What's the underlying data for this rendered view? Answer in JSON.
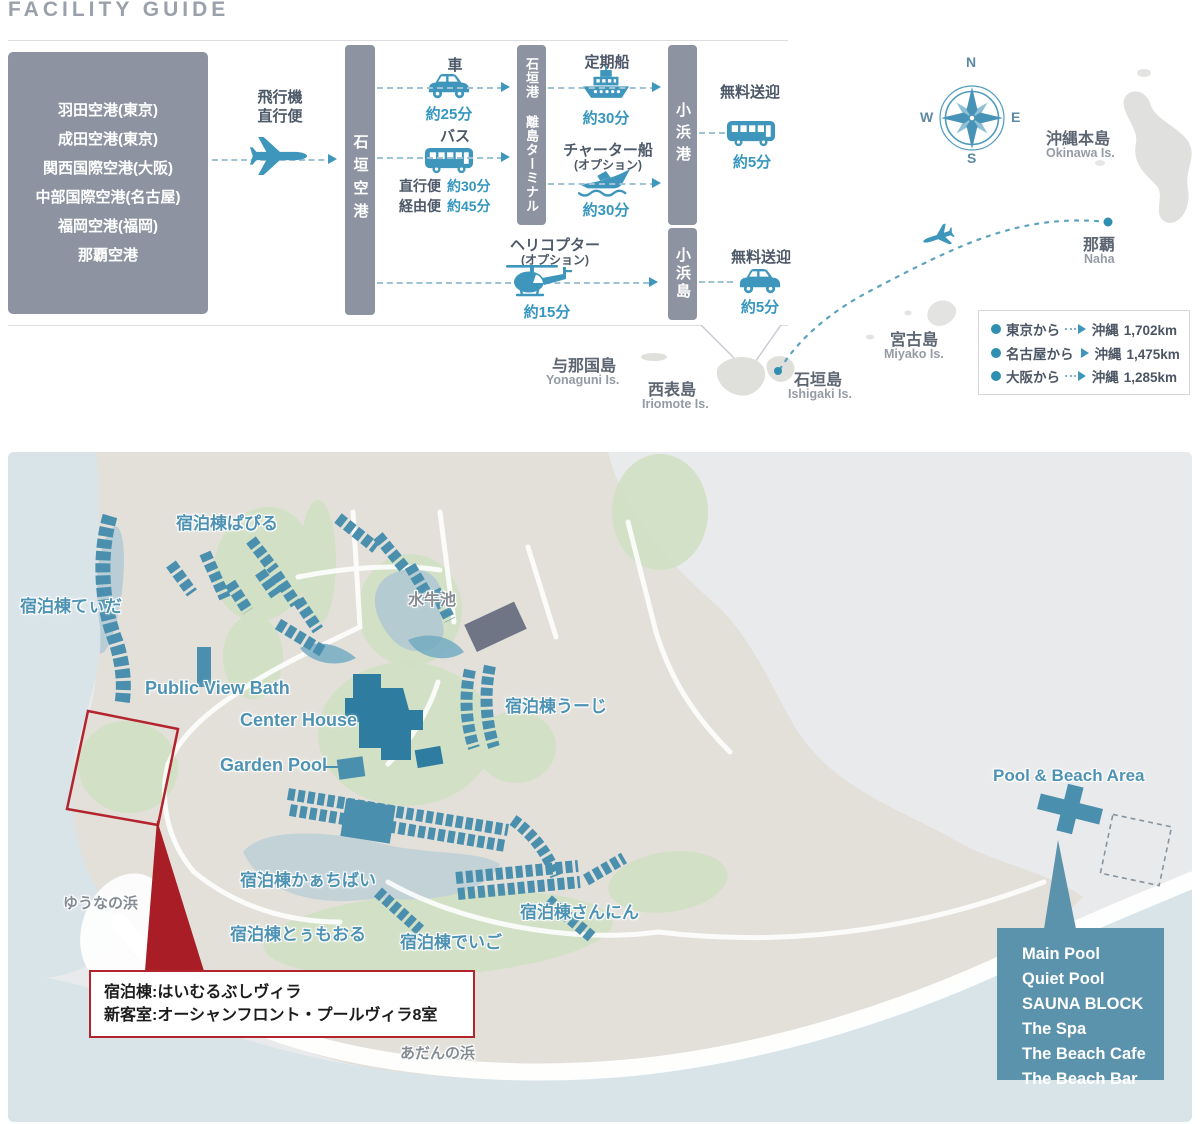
{
  "colors": {
    "accent_blue": "#3e96bc",
    "bar_gray": "#8d93a0",
    "map_building_blue": "#4a8fad",
    "center_house_blue": "#2e7da1",
    "callout_blue": "#5b92ac",
    "alert_red": "#b3242c",
    "sea": "#d9e4e9",
    "land": "#e3e0da",
    "map_label_blue": "#4e93b4"
  },
  "page": {
    "title": "FACILITY GUIDE"
  },
  "access": {
    "airports": [
      "羽田空港(東京)",
      "成田空港(東京)",
      "関西国際空港(大阪)",
      "中部国際空港(名古屋)",
      "福岡空港(福岡)",
      "那覇空港"
    ],
    "flight_label": "飛行機\n直行便",
    "ishigaki_airport": "石垣空港",
    "terminal": "石垣港 離島ターミナル",
    "kohama_port": "小浜港",
    "kohama_island": "小浜島",
    "car": {
      "label": "車",
      "time": "約25分"
    },
    "bus": {
      "label": "バス",
      "direct_label": "直行便",
      "direct_time": "約30分",
      "via_label": "経由便",
      "via_time": "約45分"
    },
    "ferry": {
      "label": "定期船",
      "time": "約30分"
    },
    "charter": {
      "label": "チャーター船",
      "option": "(オプション)",
      "time": "約30分"
    },
    "shuttle_bus": {
      "label": "無料送迎",
      "time": "約5分"
    },
    "shuttle_car": {
      "label": "無料送迎",
      "time": "約5分"
    },
    "helicopter": {
      "label": "ヘリコプター",
      "option": "(オプション)",
      "time": "約15分"
    }
  },
  "area_map": {
    "compass": {
      "n": "N",
      "e": "E",
      "s": "S",
      "w": "W"
    },
    "okinawa_jp": "沖縄本島",
    "okinawa_en": "Okinawa Is.",
    "naha_jp": "那覇",
    "naha_en": "Naha",
    "miyako_jp": "宮古島",
    "miyako_en": "Miyako Is.",
    "ishigaki_jp": "石垣島",
    "ishigaki_en": "Ishigaki Is.",
    "iriomote_jp": "西表島",
    "iriomote_en": "Iriomote Is.",
    "yonaguni_jp": "与那国島",
    "yonaguni_en": "Yonaguni Is.",
    "distances": [
      {
        "from": "東京から",
        "dest": "沖縄",
        "km": "1,702km"
      },
      {
        "from": "名古屋から",
        "dest": "沖縄",
        "km": "1,475km"
      },
      {
        "from": "大阪から",
        "dest": "沖縄",
        "km": "1,285km"
      }
    ]
  },
  "resort": {
    "pabiru": "宿泊棟ぱぴる",
    "tida": "宿泊棟てぃだ",
    "suigyu_pond": "水牛池",
    "public_view_bath": "Public View Bath",
    "center_house": "Center House",
    "garden_pool": "Garden Pool",
    "uuji": "宿泊棟うーじ",
    "kaachibai": "宿泊棟かぁちばい",
    "tuumooru": "宿泊棟とぅもおる",
    "deigo": "宿泊棟でいご",
    "sannin": "宿泊棟さんにん",
    "yuuna_beach": "ゆうなの浜",
    "adan_beach": "あだんの浜",
    "pool_beach_area": "Pool & Beach Area",
    "villa_callout_line1": "宿泊棟:はいむるぶしヴィラ",
    "villa_callout_line2": "新客室:オーシャンフロント・プールヴィラ8室",
    "beach_facilities": [
      "Main Pool",
      "Quiet Pool",
      "SAUNA BLOCK",
      "The Spa",
      "The Beach Cafe",
      "The Beach Bar"
    ]
  }
}
